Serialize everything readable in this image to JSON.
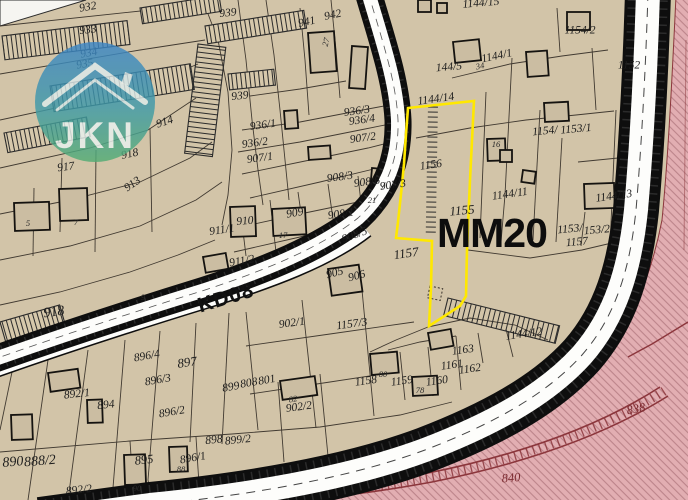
{
  "map": {
    "zone_label": "MM20",
    "road_label": "KD08",
    "logo_text": "JKN",
    "colors": {
      "parcel_fill": "#d2c4a8",
      "boundary_line": "#3a332b",
      "highlight_yellow": "#ffe800",
      "road_white": "#fdfdfb",
      "road_casing": "#0e0e0e",
      "restricted_pink": "#e2aeb2",
      "restricted_line": "#8c363c",
      "logo_blue": "#3c85c6",
      "logo_green": "#53ad74"
    },
    "labels": [
      {
        "t": "932",
        "x": 88,
        "y": 8,
        "r": -10
      },
      {
        "t": "933",
        "x": 88,
        "y": 31,
        "r": -6
      },
      {
        "t": "939",
        "x": 228,
        "y": 14,
        "r": -6
      },
      {
        "t": "941",
        "x": 307,
        "y": 23,
        "r": -12
      },
      {
        "t": "942",
        "x": 333,
        "y": 16,
        "r": -12
      },
      {
        "t": "934",
        "x": 89,
        "y": 54,
        "r": -10
      },
      {
        "t": "935",
        "x": 85,
        "y": 65,
        "r": -10
      },
      {
        "t": "1144/15",
        "x": 481,
        "y": 4,
        "r": -5
      },
      {
        "t": "144/5",
        "x": 449,
        "y": 68,
        "r": -5
      },
      {
        "t": "1144/1",
        "x": 497,
        "y": 57,
        "r": -12
      },
      {
        "t": "1154/2",
        "x": 580,
        "y": 31,
        "r": 0
      },
      {
        "t": "1152",
        "x": 629,
        "y": 66,
        "r": 0
      },
      {
        "t": "939",
        "x": 240,
        "y": 97,
        "r": -6
      },
      {
        "t": "936/3",
        "x": 357,
        "y": 112,
        "r": -8
      },
      {
        "t": "936/4",
        "x": 362,
        "y": 121,
        "r": -8
      },
      {
        "t": "936/1",
        "x": 263,
        "y": 126,
        "r": -8
      },
      {
        "t": "936/2",
        "x": 255,
        "y": 144,
        "r": -8
      },
      {
        "t": "907/2",
        "x": 363,
        "y": 139,
        "r": -8
      },
      {
        "t": "907/1",
        "x": 260,
        "y": 159,
        "r": -8
      },
      {
        "t": "914",
        "x": 165,
        "y": 123,
        "r": -18
      },
      {
        "t": "918",
        "x": 130,
        "y": 155,
        "r": -12
      },
      {
        "t": "917",
        "x": 66,
        "y": 168,
        "r": -8
      },
      {
        "t": "913",
        "x": 133,
        "y": 185,
        "r": -35
      },
      {
        "t": "1154/",
        "x": 545,
        "y": 132,
        "r": -5
      },
      {
        "t": "1153/1",
        "x": 576,
        "y": 130,
        "r": -5
      },
      {
        "t": "1156",
        "x": 431,
        "y": 166,
        "r": -8
      },
      {
        "t": "908/3",
        "x": 340,
        "y": 178,
        "r": -8
      },
      {
        "t": "908/6",
        "x": 367,
        "y": 183,
        "r": -8
      },
      {
        "t": "907/3",
        "x": 393,
        "y": 186,
        "r": -8
      },
      {
        "t": "909",
        "x": 295,
        "y": 214,
        "r": -10
      },
      {
        "t": "910",
        "x": 245,
        "y": 222,
        "r": -5
      },
      {
        "t": "908/1",
        "x": 341,
        "y": 215,
        "r": -8
      },
      {
        "t": "911/1",
        "x": 222,
        "y": 231,
        "r": -8
      },
      {
        "t": "908/5",
        "x": 355,
        "y": 236,
        "r": -20
      },
      {
        "t": "1155",
        "x": 462,
        "y": 210,
        "r": -5,
        "s": 13
      },
      {
        "t": "1144/11",
        "x": 510,
        "y": 195,
        "r": -8
      },
      {
        "t": "1144/13",
        "x": 614,
        "y": 197,
        "r": -8
      },
      {
        "t": "1153/",
        "x": 570,
        "y": 230,
        "r": -5
      },
      {
        "t": "153/2",
        "x": 597,
        "y": 231,
        "r": -5
      },
      {
        "t": "1157",
        "x": 577,
        "y": 243,
        "r": -5
      },
      {
        "t": "911/2",
        "x": 242,
        "y": 262,
        "r": -10
      },
      {
        "t": "905",
        "x": 335,
        "y": 274,
        "r": -15
      },
      {
        "t": "906",
        "x": 357,
        "y": 277,
        "r": -15
      },
      {
        "t": "918",
        "x": 54,
        "y": 313,
        "r": -8,
        "s": 14
      },
      {
        "t": "1157",
        "x": 406,
        "y": 253,
        "r": -8,
        "s": 13
      },
      {
        "t": "902/1",
        "x": 292,
        "y": 324,
        "r": -8
      },
      {
        "t": "1157/3",
        "x": 352,
        "y": 325,
        "r": -8
      },
      {
        "t": "896/4",
        "x": 147,
        "y": 357,
        "r": -10
      },
      {
        "t": "897",
        "x": 187,
        "y": 362,
        "r": -8,
        "s": 13
      },
      {
        "t": "1158",
        "x": 366,
        "y": 382,
        "r": -8
      },
      {
        "t": "1159",
        "x": 402,
        "y": 382,
        "r": -8
      },
      {
        "t": "1160",
        "x": 437,
        "y": 382,
        "r": -8
      },
      {
        "t": "1163",
        "x": 463,
        "y": 351,
        "r": -8
      },
      {
        "t": "1161",
        "x": 452,
        "y": 366,
        "r": -8
      },
      {
        "t": "1162",
        "x": 470,
        "y": 370,
        "r": -8
      },
      {
        "t": "1144/12",
        "x": 524,
        "y": 335,
        "r": -8
      },
      {
        "t": "896/3",
        "x": 158,
        "y": 381,
        "r": -10
      },
      {
        "t": "896/2",
        "x": 172,
        "y": 413,
        "r": -10
      },
      {
        "t": "801",
        "x": 267,
        "y": 381,
        "r": -10
      },
      {
        "t": "899",
        "x": 231,
        "y": 388,
        "r": -10
      },
      {
        "t": "808",
        "x": 249,
        "y": 384,
        "r": -10
      },
      {
        "t": "902/2",
        "x": 299,
        "y": 408,
        "r": -8
      },
      {
        "t": "892/1",
        "x": 77,
        "y": 395,
        "r": -6
      },
      {
        "t": "894",
        "x": 106,
        "y": 406,
        "r": -6
      },
      {
        "t": "890",
        "x": 13,
        "y": 463,
        "r": -5,
        "s": 14
      },
      {
        "t": "888/2",
        "x": 40,
        "y": 462,
        "r": -5,
        "s": 14
      },
      {
        "t": "895",
        "x": 144,
        "y": 460,
        "r": -6,
        "s": 12.5
      },
      {
        "t": "896/1",
        "x": 193,
        "y": 459,
        "r": -10
      },
      {
        "t": "898",
        "x": 214,
        "y": 441,
        "r": -6
      },
      {
        "t": "899/2",
        "x": 238,
        "y": 441,
        "r": -6
      },
      {
        "t": "892/2",
        "x": 79,
        "y": 491,
        "r": -6
      },
      {
        "t": "1144/14",
        "x": 436,
        "y": 100,
        "r": -8
      },
      {
        "t": "838",
        "x": 636,
        "y": 409,
        "r": -10,
        "s": 12.5,
        "c": "pink"
      },
      {
        "t": "840",
        "x": 511,
        "y": 478,
        "r": -5,
        "s": 12.5,
        "c": "pink"
      },
      {
        "t": "27",
        "x": 326,
        "y": 42,
        "r": -75,
        "c": "b"
      },
      {
        "t": "34",
        "x": 480,
        "y": 66,
        "r": -10,
        "c": "b"
      },
      {
        "t": "16",
        "x": 496,
        "y": 144,
        "r": 0,
        "c": "b"
      },
      {
        "t": "17",
        "x": 283,
        "y": 235,
        "r": 0,
        "c": "b"
      },
      {
        "t": "21",
        "x": 372,
        "y": 200,
        "r": 0,
        "c": "b"
      },
      {
        "t": "5",
        "x": 28,
        "y": 223,
        "r": 0,
        "c": "b"
      },
      {
        "t": "7",
        "x": 76,
        "y": 222,
        "r": 0,
        "c": "b"
      },
      {
        "t": "9",
        "x": 143,
        "y": 297,
        "r": 0,
        "c": "b"
      },
      {
        "t": "80",
        "x": 383,
        "y": 374,
        "r": 0,
        "c": "b"
      },
      {
        "t": "82",
        "x": 293,
        "y": 399,
        "r": -10,
        "c": "b"
      },
      {
        "t": "88",
        "x": 181,
        "y": 469,
        "r": 0,
        "c": "b"
      },
      {
        "t": "90",
        "x": 137,
        "y": 488,
        "r": 0,
        "c": "b"
      },
      {
        "t": "78",
        "x": 420,
        "y": 390,
        "r": 0,
        "c": "b"
      }
    ]
  }
}
